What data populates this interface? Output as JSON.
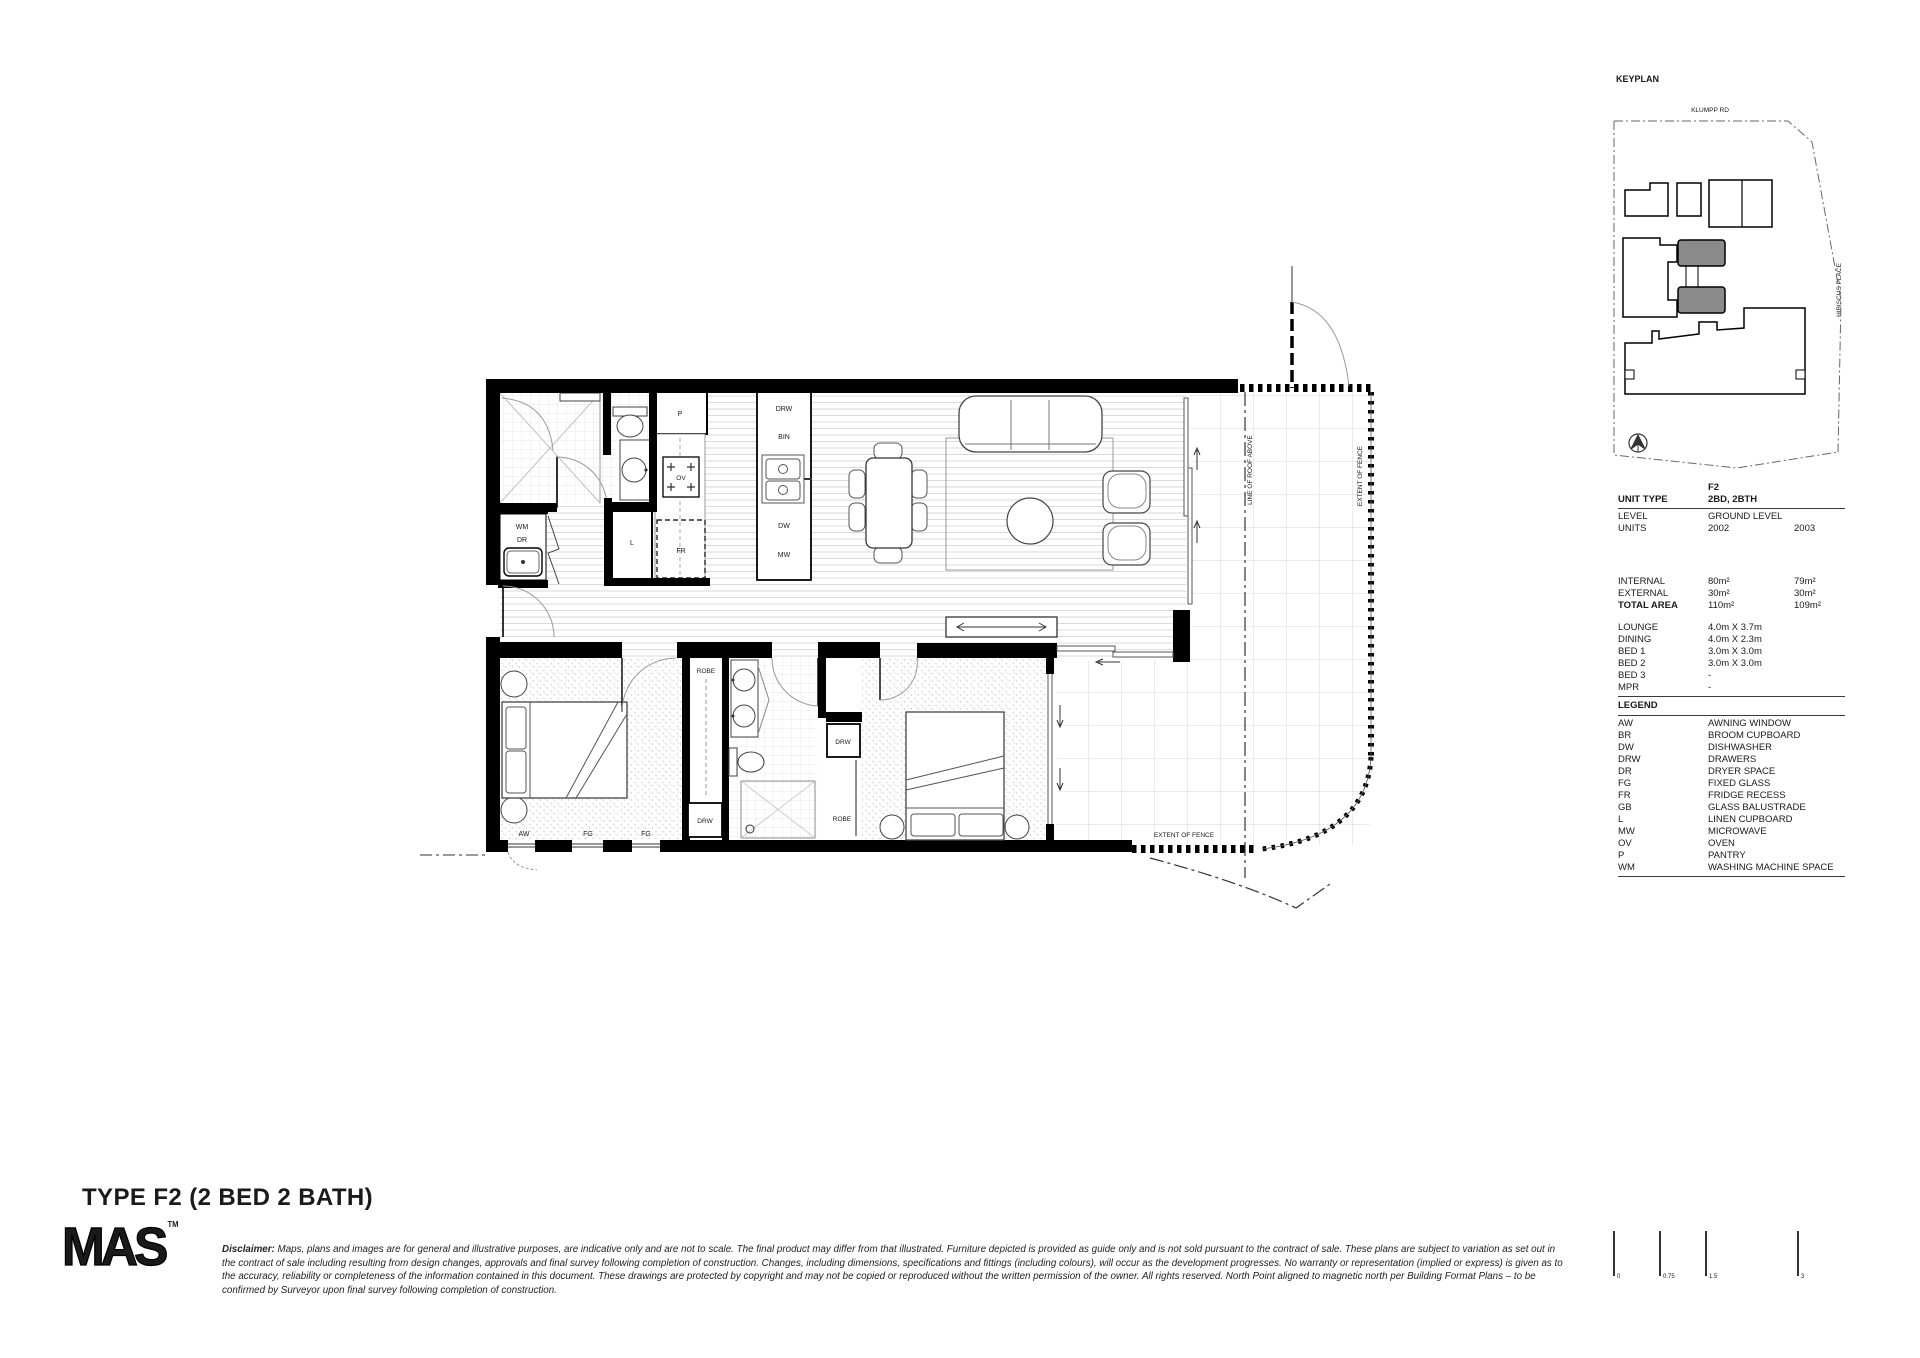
{
  "title": "TYPE F2 (2 BED 2 BATH)",
  "logo": {
    "text": "MAS",
    "tm": "TM"
  },
  "disclaimer": {
    "label": "Disclaimer:",
    "text": " Maps, plans and images are for general and illustrative purposes, are indicative only and are not to scale. The final product may differ from that illustrated. Furniture depicted is provided as guide only and is not sold pursuant to the contract of sale. These plans are subject to variation as set out in the contract of sale including resulting from design changes, approvals and final survey following completion of construction. Changes, including dimensions, specifications and fittings (including colours), will occur as the development progresses. No warranty or representation (implied or express) is given as to the accuracy, reliability or completeness of the information contained in this document. These drawings are protected by copyright and may not be copied or reproduced without the written permission of the owner. All rights reserved. North Point aligned to magnetic north per Building Format Plans – to be confirmed by Surveyor upon final survey following completion of construction."
  },
  "keyplan": {
    "title": "KEYPLAN",
    "road_top": "KLUMPP RD",
    "road_right": "HIBISCUS PLACE"
  },
  "info_table": {
    "code": "F2",
    "type_label": "UNIT TYPE",
    "type_value": "2BD, 2BTH",
    "level_label": "LEVEL",
    "level_value": "GROUND LEVEL",
    "units_label": "UNITS",
    "unit_1": "2002",
    "unit_2": "2003",
    "internal_label": "INTERNAL",
    "internal_1": "80m²",
    "internal_2": "79m²",
    "external_label": "EXTERNAL",
    "external_1": "30m²",
    "external_2": "30m²",
    "total_label": "TOTAL AREA",
    "total_1": "110m²",
    "total_2": "109m²",
    "lounge_label": "LOUNGE",
    "lounge_value": "4.0m X 3.7m",
    "dining_label": "DINING",
    "dining_value": "4.0m X 2.3m",
    "bed1_label": "BED 1",
    "bed1_value": "3.0m X 3.0m",
    "bed2_label": "BED 2",
    "bed2_value": "3.0m X 3.0m",
    "bed3_label": "BED 3",
    "bed3_value": "-",
    "mpr_label": "MPR",
    "mpr_value": "-"
  },
  "legend": {
    "title": "LEGEND",
    "items": [
      {
        "abbr": "AW",
        "desc": "AWNING WINDOW"
      },
      {
        "abbr": "BR",
        "desc": "BROOM CUPBOARD"
      },
      {
        "abbr": "DW",
        "desc": "DISHWASHER"
      },
      {
        "abbr": "DRW",
        "desc": "DRAWERS"
      },
      {
        "abbr": "DR",
        "desc": "DRYER SPACE"
      },
      {
        "abbr": "FG",
        "desc": "FIXED GLASS"
      },
      {
        "abbr": "FR",
        "desc": "FRIDGE RECESS"
      },
      {
        "abbr": "GB",
        "desc": "GLASS BALUSTRADE"
      },
      {
        "abbr": "L",
        "desc": "LINEN CUPBOARD"
      },
      {
        "abbr": "MW",
        "desc": "MICROWAVE"
      },
      {
        "abbr": "OV",
        "desc": "OVEN"
      },
      {
        "abbr": "P",
        "desc": "PANTRY"
      },
      {
        "abbr": "WM",
        "desc": "WASHING MACHINE SPACE"
      }
    ]
  },
  "plan": {
    "labels": {
      "p": "P",
      "ov": "OV",
      "l": "L",
      "fr": "FR",
      "drw": "DRW",
      "bin": "BIN",
      "dw": "DW",
      "mw": "MW",
      "wm": "WM",
      "dr": "DR",
      "robe": "ROBE",
      "aw": "AW",
      "fg": "FG",
      "line_of_roof_above": "LINE OF ROOF ABOVE",
      "extent_of_fence": "EXTENT OF FENCE"
    }
  },
  "scale_bar": {
    "t0": "0",
    "t1": "0.75",
    "t2": "1.5",
    "t3": "3"
  },
  "colors": {
    "wall": "#000000",
    "shaded_unit": "#8a8a8a",
    "accent": "#000000"
  }
}
